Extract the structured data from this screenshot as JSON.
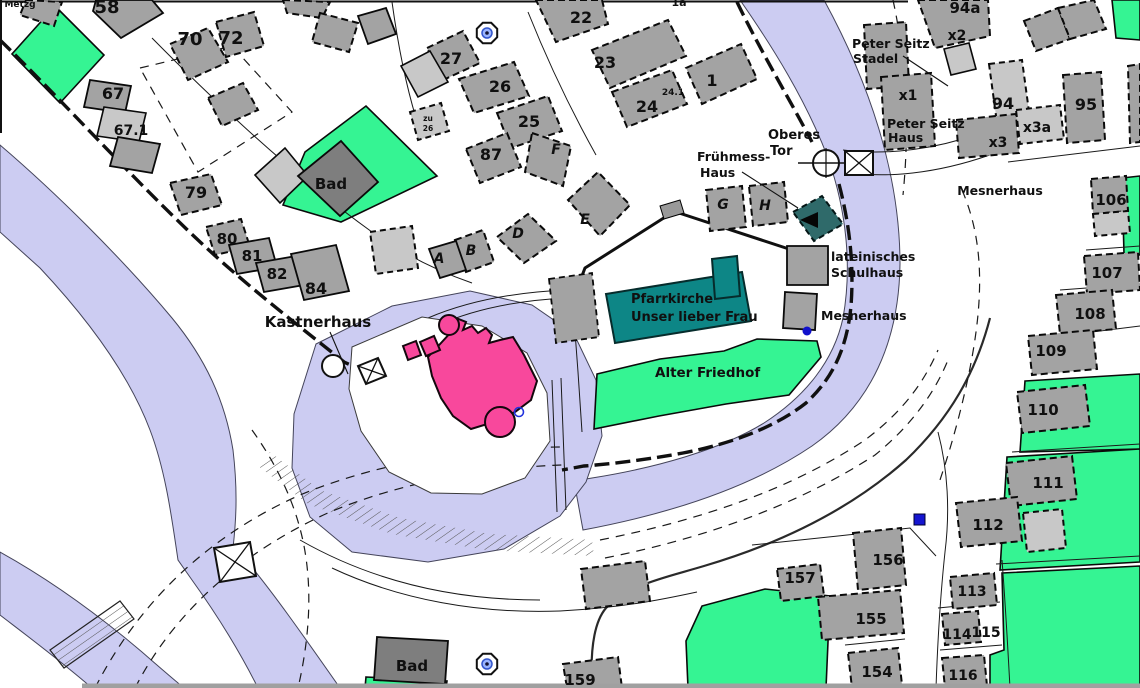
{
  "map": {
    "colors": {
      "river": "#ccccf2",
      "open_green": "#35f493",
      "building_gray": "#a3a3a3",
      "building_light_gray": "#c8c8c8",
      "building_dark_gray": "#7e7e7e",
      "castle_pink": "#f8489c",
      "church_teal": "#0d8686",
      "fruehmess_dark_teal": "#2f6a6a",
      "marker_blue": "#1515d0"
    },
    "icons": [
      {
        "name": "fountain-icon",
        "glyph": "octagon-with-blue-circle"
      },
      {
        "name": "town-gate-icon",
        "glyph": "circle-with-crosshair"
      },
      {
        "name": "bridge-icon",
        "glyph": "box-with-x"
      },
      {
        "name": "stairs-icon",
        "glyph": "hatched-ramp"
      },
      {
        "name": "blue-square-marker",
        "glyph": "filled-blue-square"
      },
      {
        "name": "blue-dot-marker",
        "glyph": "filled-blue-dot"
      },
      {
        "name": "blue-circle-marker",
        "glyph": "open-blue-circle"
      }
    ],
    "labels": [
      {
        "name": "label-metzg",
        "text": "Metzg",
        "x": 20,
        "y": 7,
        "size": 9
      },
      {
        "name": "label-58",
        "text": "58",
        "x": 107,
        "y": 13,
        "size": 18
      },
      {
        "name": "label-70",
        "text": "70",
        "x": 190,
        "y": 45,
        "size": 18
      },
      {
        "name": "label-72",
        "text": "72",
        "x": 231,
        "y": 44,
        "size": 18
      },
      {
        "name": "label-67",
        "text": "67",
        "x": 113,
        "y": 99,
        "size": 16
      },
      {
        "name": "label-67-1",
        "text": "67.1",
        "x": 131,
        "y": 135,
        "size": 14
      },
      {
        "name": "label-79",
        "text": "79",
        "x": 196,
        "y": 198,
        "size": 16
      },
      {
        "name": "label-80",
        "text": "80",
        "x": 227,
        "y": 244,
        "size": 15
      },
      {
        "name": "label-81",
        "text": "81",
        "x": 252,
        "y": 261,
        "size": 15
      },
      {
        "name": "label-82",
        "text": "82",
        "x": 277,
        "y": 279,
        "size": 15
      },
      {
        "name": "label-84",
        "text": "84",
        "x": 316,
        "y": 294,
        "size": 16
      },
      {
        "name": "label-bad-top",
        "text": "Bad",
        "x": 331,
        "y": 189,
        "size": 15
      },
      {
        "name": "label-27",
        "text": "27",
        "x": 451,
        "y": 64,
        "size": 16
      },
      {
        "name": "label-26",
        "text": "26",
        "x": 500,
        "y": 92,
        "size": 16
      },
      {
        "name": "label-25",
        "text": "25",
        "x": 529,
        "y": 127,
        "size": 16
      },
      {
        "name": "label-87",
        "text": "87",
        "x": 491,
        "y": 160,
        "size": 16
      },
      {
        "name": "label-zu-26a",
        "text": "zu",
        "x": 428,
        "y": 121,
        "size": 7.5
      },
      {
        "name": "label-zu-26b",
        "text": "26",
        "x": 428,
        "y": 131,
        "size": 7.5
      },
      {
        "name": "label-22",
        "text": "22",
        "x": 581,
        "y": 23,
        "size": 16
      },
      {
        "name": "label-23",
        "text": "23",
        "x": 605,
        "y": 68,
        "size": 16
      },
      {
        "name": "label-24",
        "text": "24",
        "x": 647,
        "y": 112,
        "size": 16
      },
      {
        "name": "label-24-1",
        "text": "24.1",
        "x": 673,
        "y": 95,
        "size": 9
      },
      {
        "name": "label-1",
        "text": "1",
        "x": 712,
        "y": 86,
        "size": 16
      },
      {
        "name": "label-1a",
        "text": "1a",
        "x": 679,
        "y": 6,
        "size": 11
      },
      {
        "name": "label-A",
        "text": "A",
        "x": 439,
        "y": 263,
        "size": 14,
        "italic": true
      },
      {
        "name": "label-B",
        "text": "B",
        "x": 471,
        "y": 255,
        "size": 14,
        "italic": true
      },
      {
        "name": "label-D",
        "text": "D",
        "x": 518,
        "y": 238,
        "size": 14,
        "italic": true
      },
      {
        "name": "label-E",
        "text": "E",
        "x": 585,
        "y": 224,
        "size": 14,
        "italic": true
      },
      {
        "name": "label-F",
        "text": "F",
        "x": 556,
        "y": 154,
        "size": 14,
        "italic": true
      },
      {
        "name": "label-G",
        "text": "G",
        "x": 723,
        "y": 209,
        "size": 14,
        "italic": true
      },
      {
        "name": "label-H",
        "text": "H",
        "x": 765,
        "y": 210,
        "size": 14,
        "italic": true
      },
      {
        "name": "label-fruehmess-1",
        "text": "Frühmess-",
        "x": 697,
        "y": 161,
        "size": 12.5,
        "anchor": "start"
      },
      {
        "name": "label-fruehmess-2",
        "text": "Haus",
        "x": 700,
        "y": 177,
        "size": 12.5,
        "anchor": "start"
      },
      {
        "name": "label-oberes",
        "text": "Oberes",
        "x": 768,
        "y": 139,
        "size": 13,
        "anchor": "start"
      },
      {
        "name": "label-tor",
        "text": "Tor",
        "x": 770,
        "y": 155,
        "size": 13,
        "anchor": "start"
      },
      {
        "name": "label-peter-seitz-stadel-1",
        "text": "Peter Seitz",
        "x": 852,
        "y": 48,
        "size": 12.5,
        "anchor": "start"
      },
      {
        "name": "label-peter-seitz-stadel-2",
        "text": "Stadel",
        "x": 853,
        "y": 63,
        "size": 12.5,
        "anchor": "start"
      },
      {
        "name": "label-x2",
        "text": "x2",
        "x": 957,
        "y": 40,
        "size": 14
      },
      {
        "name": "label-x1",
        "text": "x1",
        "x": 908,
        "y": 100,
        "size": 14
      },
      {
        "name": "label-peter-seitz-haus-1",
        "text": "Peter Seitz",
        "x": 887,
        "y": 128,
        "size": 12.5,
        "anchor": "start"
      },
      {
        "name": "label-peter-seitz-haus-2",
        "text": "Haus",
        "x": 888,
        "y": 142,
        "size": 12.5,
        "anchor": "start"
      },
      {
        "name": "label-94a",
        "text": "94a",
        "x": 965,
        "y": 13,
        "size": 15
      },
      {
        "name": "label-94",
        "text": "94",
        "x": 1003,
        "y": 109,
        "size": 16
      },
      {
        "name": "label-x3a",
        "text": "x3a",
        "x": 1037,
        "y": 132,
        "size": 14
      },
      {
        "name": "label-x3",
        "text": "x3",
        "x": 998,
        "y": 147,
        "size": 14
      },
      {
        "name": "label-95",
        "text": "95",
        "x": 1086,
        "y": 110,
        "size": 16
      },
      {
        "name": "label-mesnerhaus-tr",
        "text": "Mesnerhaus",
        "x": 1000,
        "y": 195,
        "size": 12.5
      },
      {
        "name": "label-106",
        "text": "106",
        "x": 1111,
        "y": 205,
        "size": 15
      },
      {
        "name": "label-107",
        "text": "107",
        "x": 1107,
        "y": 278,
        "size": 15
      },
      {
        "name": "label-108",
        "text": "108",
        "x": 1090,
        "y": 319,
        "size": 15
      },
      {
        "name": "label-109",
        "text": "109",
        "x": 1051,
        "y": 356,
        "size": 15
      },
      {
        "name": "label-110",
        "text": "110",
        "x": 1043,
        "y": 415,
        "size": 15
      },
      {
        "name": "label-111",
        "text": "111",
        "x": 1048,
        "y": 488,
        "size": 15
      },
      {
        "name": "label-112",
        "text": "112",
        "x": 988,
        "y": 530,
        "size": 15
      },
      {
        "name": "label-113",
        "text": "113",
        "x": 972,
        "y": 596,
        "size": 14
      },
      {
        "name": "label-114",
        "text": "114",
        "x": 957,
        "y": 639,
        "size": 14
      },
      {
        "name": "label-115",
        "text": "115",
        "x": 986,
        "y": 637,
        "size": 14
      },
      {
        "name": "label-116",
        "text": "116",
        "x": 963,
        "y": 680,
        "size": 14
      },
      {
        "name": "label-154",
        "text": "154",
        "x": 877,
        "y": 677,
        "size": 15
      },
      {
        "name": "label-155",
        "text": "155",
        "x": 871,
        "y": 624,
        "size": 15
      },
      {
        "name": "label-156",
        "text": "156",
        "x": 888,
        "y": 565,
        "size": 15
      },
      {
        "name": "label-157",
        "text": "157",
        "x": 800,
        "y": 583,
        "size": 15
      },
      {
        "name": "label-159",
        "text": "159",
        "x": 580,
        "y": 685,
        "size": 15
      },
      {
        "name": "label-bad-bottom",
        "text": "Bad",
        "x": 412,
        "y": 671,
        "size": 15
      },
      {
        "name": "label-kastnerhaus",
        "text": "Kastnerhaus",
        "x": 318,
        "y": 327,
        "size": 15
      },
      {
        "name": "label-pfarrkirche-1",
        "text": "Pfarrkirche",
        "x": 631,
        "y": 303,
        "size": 13,
        "anchor": "start"
      },
      {
        "name": "label-pfarrkirche-2",
        "text": "Unser lieber Frau",
        "x": 631,
        "y": 321,
        "size": 13,
        "anchor": "start"
      },
      {
        "name": "label-alter-friedhof",
        "text": "Alter Friedhof",
        "x": 655,
        "y": 377,
        "size": 13.5,
        "anchor": "start"
      },
      {
        "name": "label-lat-schulhaus-1",
        "text": "lateinisches",
        "x": 831,
        "y": 261,
        "size": 12.5,
        "anchor": "start"
      },
      {
        "name": "label-lat-schulhaus-2",
        "text": "Schulhaus",
        "x": 831,
        "y": 277,
        "size": 12.5,
        "anchor": "start"
      },
      {
        "name": "label-mesnerhaus-mid",
        "text": "Mesnerhaus",
        "x": 821,
        "y": 320,
        "size": 12.5,
        "anchor": "start"
      }
    ]
  }
}
